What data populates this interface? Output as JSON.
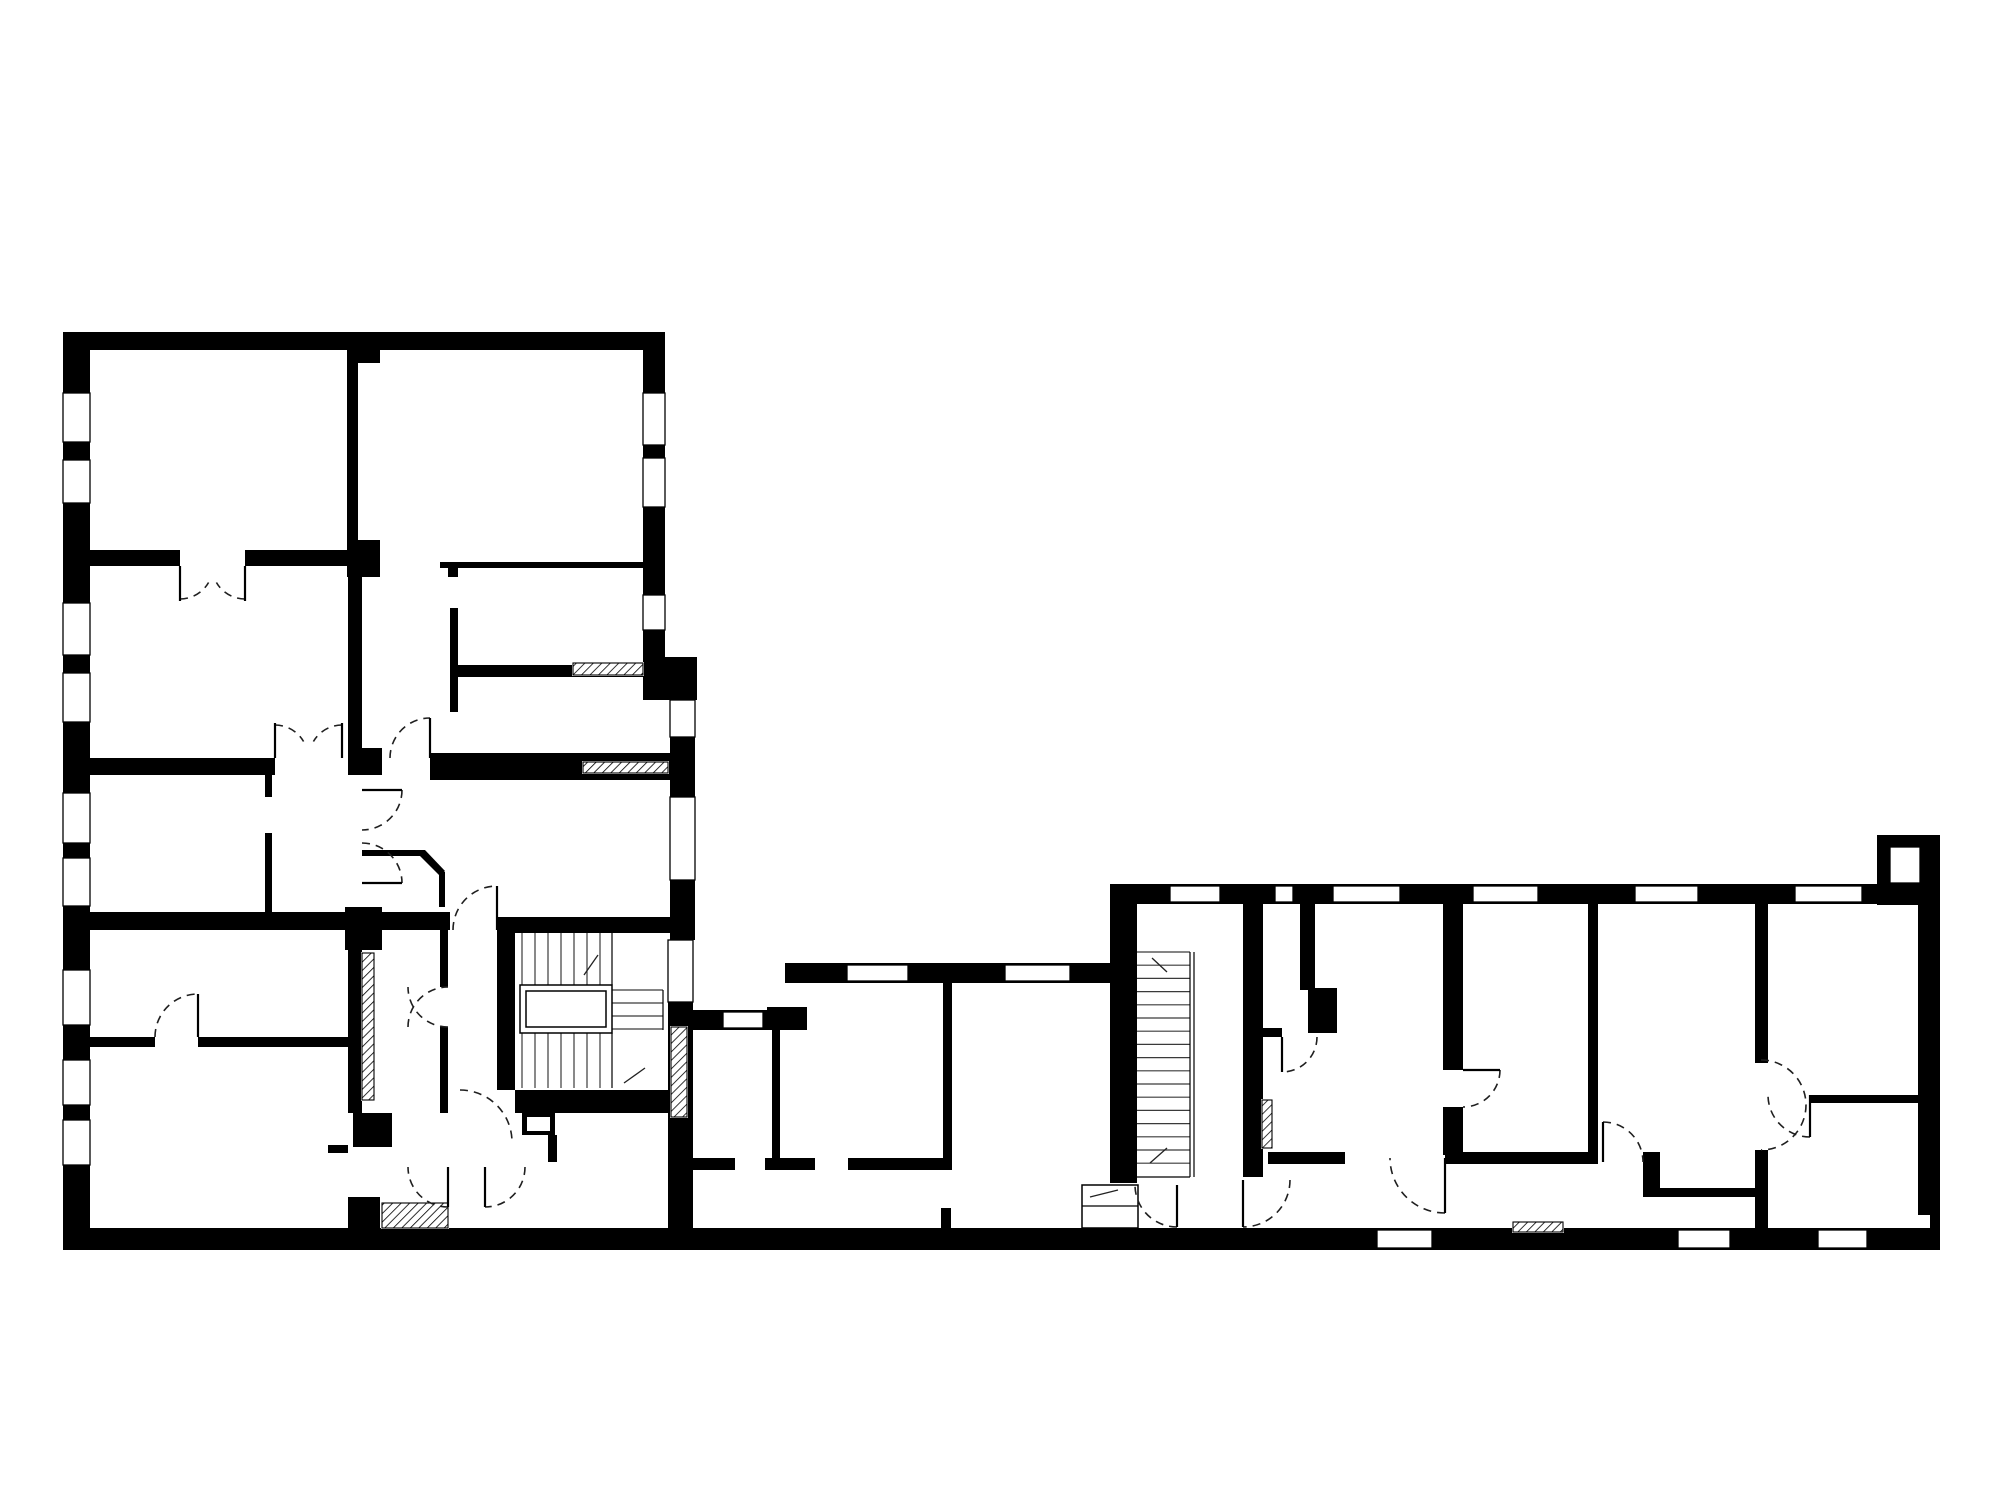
{
  "plan": {
    "canvas": {
      "width": 2000,
      "height": 1500,
      "background": "#ffffff"
    },
    "colors": {
      "wall": "#000000",
      "window_frame": "#000000",
      "tread": "#3a3a3a",
      "door_arc": "#1f1f1f",
      "hatch_line": "#000000"
    },
    "walls": [
      [
        63,
        332,
        602,
        18
      ],
      [
        63,
        332,
        27,
        918
      ],
      [
        643,
        332,
        22,
        330
      ],
      [
        643,
        657,
        54,
        43
      ],
      [
        670,
        697,
        25,
        243
      ],
      [
        668,
        940,
        25,
        290
      ],
      [
        63,
        1228,
        1877,
        22
      ],
      [
        347,
        332,
        33,
        31
      ],
      [
        347,
        350,
        11,
        192
      ],
      [
        347,
        540,
        33,
        37
      ],
      [
        90,
        550,
        90,
        16
      ],
      [
        245,
        550,
        102,
        16
      ],
      [
        440,
        562,
        207,
        6
      ],
      [
        448,
        568,
        10,
        9
      ],
      [
        450,
        608,
        8,
        104
      ],
      [
        458,
        665,
        189,
        12
      ],
      [
        430,
        753,
        245,
        27
      ],
      [
        348,
        577,
        14,
        176
      ],
      [
        348,
        748,
        34,
        27
      ],
      [
        90,
        758,
        185,
        17
      ],
      [
        265,
        775,
        7,
        22
      ],
      [
        265,
        833,
        7,
        79
      ],
      [
        90,
        912,
        258,
        18
      ],
      [
        345,
        907,
        37,
        43
      ],
      [
        382,
        912,
        68,
        18
      ],
      [
        497,
        917,
        196,
        16
      ],
      [
        362,
        850,
        63,
        6
      ],
      [
        439,
        872,
        6,
        35
      ],
      [
        348,
        950,
        14,
        163
      ],
      [
        353,
        1113,
        39,
        34
      ],
      [
        328,
        1145,
        20,
        8
      ],
      [
        90,
        1037,
        65,
        10
      ],
      [
        198,
        1037,
        150,
        10
      ],
      [
        440,
        930,
        8,
        57
      ],
      [
        440,
        1027,
        8,
        86
      ],
      [
        497,
        933,
        18,
        157
      ],
      [
        515,
        1090,
        178,
        23
      ],
      [
        522,
        1113,
        33,
        22
      ],
      [
        548,
        1135,
        9,
        27
      ],
      [
        348,
        1197,
        32,
        31
      ],
      [
        693,
        1010,
        114,
        20
      ],
      [
        785,
        963,
        330,
        20
      ],
      [
        767,
        1007,
        40,
        23
      ],
      [
        772,
        1030,
        8,
        128
      ],
      [
        943,
        983,
        9,
        187
      ],
      [
        693,
        1158,
        42,
        12
      ],
      [
        765,
        1158,
        50,
        12
      ],
      [
        848,
        1158,
        102,
        12
      ],
      [
        941,
        1208,
        10,
        20
      ],
      [
        1110,
        884,
        830,
        20
      ],
      [
        1110,
        904,
        27,
        279
      ],
      [
        1877,
        835,
        63,
        70
      ],
      [
        1918,
        904,
        22,
        324
      ],
      [
        1243,
        904,
        20,
        273
      ],
      [
        1300,
        904,
        15,
        86
      ],
      [
        1308,
        988,
        29,
        45
      ],
      [
        1260,
        1028,
        22,
        9
      ],
      [
        1443,
        904,
        20,
        166
      ],
      [
        1443,
        1107,
        20,
        48
      ],
      [
        1588,
        904,
        10,
        253
      ],
      [
        1268,
        1152,
        77,
        12
      ],
      [
        1445,
        1152,
        153,
        12
      ],
      [
        1643,
        1152,
        17,
        45
      ],
      [
        1660,
        1188,
        97,
        9
      ],
      [
        1755,
        904,
        13,
        159
      ],
      [
        1755,
        1150,
        13,
        78
      ],
      [
        1810,
        1095,
        108,
        8
      ]
    ],
    "polygons": [
      [
        [
          425,
          850
        ],
        [
          445,
          871
        ],
        [
          440,
          876
        ],
        [
          420,
          856
        ]
      ]
    ],
    "windows": [
      [
        63,
        393,
        27,
        49
      ],
      [
        63,
        460,
        27,
        43
      ],
      [
        63,
        603,
        27,
        52
      ],
      [
        63,
        673,
        27,
        49
      ],
      [
        63,
        793,
        27,
        50
      ],
      [
        63,
        858,
        27,
        48
      ],
      [
        63,
        970,
        27,
        55
      ],
      [
        63,
        1060,
        27,
        45
      ],
      [
        63,
        1120,
        27,
        45
      ],
      [
        643,
        393,
        22,
        52
      ],
      [
        643,
        458,
        22,
        49
      ],
      [
        643,
        595,
        22,
        35
      ],
      [
        670,
        700,
        25,
        37
      ],
      [
        670,
        797,
        25,
        83
      ],
      [
        668,
        940,
        25,
        62
      ],
      [
        723,
        1012,
        40,
        16
      ],
      [
        847,
        965,
        61,
        16
      ],
      [
        1005,
        965,
        65,
        16
      ],
      [
        1170,
        886,
        50,
        16
      ],
      [
        1275,
        886,
        18,
        16
      ],
      [
        1333,
        886,
        67,
        16
      ],
      [
        1473,
        886,
        65,
        16
      ],
      [
        1635,
        886,
        63,
        16
      ],
      [
        1795,
        886,
        67,
        16
      ],
      [
        1890,
        847,
        30,
        36
      ],
      [
        1377,
        1230,
        55,
        18
      ],
      [
        1678,
        1230,
        52,
        18
      ],
      [
        1818,
        1230,
        49,
        18
      ]
    ],
    "white_notches": [
      [
        527,
        1117,
        23,
        14
      ],
      [
        1918,
        1215,
        12,
        13
      ]
    ],
    "hatches": [
      [
        573,
        663,
        70,
        12
      ],
      [
        583,
        762,
        85,
        11
      ],
      [
        362,
        953,
        12,
        147
      ],
      [
        671,
        1027,
        16,
        90
      ],
      [
        382,
        1203,
        66,
        25
      ],
      [
        1262,
        1100,
        10,
        48
      ],
      [
        1513,
        1222,
        50,
        10
      ]
    ],
    "stair_outlines": [
      [
        520,
        985,
        92,
        48
      ],
      [
        526,
        991,
        80,
        36
      ],
      [
        1082,
        1185,
        56,
        43
      ]
    ],
    "stair_treads": [
      {
        "o": "v",
        "p1": 522,
        "p2": 612,
        "s": 13,
        "a": 933,
        "b": 985
      },
      {
        "o": "v",
        "p1": 522,
        "p2": 612,
        "s": 13,
        "a": 1033,
        "b": 1088
      },
      {
        "o": "h",
        "p1": 990,
        "p2": 1030,
        "s": 13,
        "a": 612,
        "b": 663
      },
      {
        "o": "h",
        "p1": 952,
        "p2": 1176,
        "s": 13.2,
        "a": 1137,
        "b": 1190
      },
      {
        "o": "v",
        "p1": 1096,
        "p2": 1124,
        "s": 14,
        "a": 1185,
        "b": 1228
      }
    ],
    "thin_lines": [
      [
        612,
        933,
        612,
        985
      ],
      [
        612,
        1033,
        612,
        1088
      ],
      [
        663,
        990,
        663,
        1030
      ],
      [
        1190,
        952,
        1190,
        1177
      ],
      [
        1194,
        952,
        1194,
        1177
      ],
      [
        1082,
        1206,
        1138,
        1206
      ],
      [
        1137,
        1177,
        1190,
        1177
      ]
    ],
    "arrows": [
      [
        598,
        955,
        584,
        975
      ],
      [
        645,
        1068,
        624,
        1083
      ],
      [
        1152,
        958,
        1167,
        972
      ],
      [
        1167,
        1148,
        1150,
        1163
      ],
      [
        1090,
        1197,
        1118,
        1190
      ]
    ],
    "doors": [
      {
        "c": [
          180,
          566
        ],
        "r": 33,
        "a0": 90,
        "a1": 30,
        "sw": 0,
        "leaf": [
          180,
          566,
          180,
          601
        ]
      },
      {
        "c": [
          245,
          566
        ],
        "r": 33,
        "a0": 90,
        "a1": 150,
        "sw": 1,
        "leaf": [
          245,
          566,
          245,
          601
        ]
      },
      {
        "c": [
          275,
          758
        ],
        "r": 33,
        "a0": 270,
        "a1": 330,
        "sw": 1,
        "leaf": [
          275,
          758,
          275,
          723
        ]
      },
      {
        "c": [
          342,
          758
        ],
        "r": 33,
        "a0": 270,
        "a1": 210,
        "sw": 0,
        "leaf": [
          342,
          758,
          342,
          723
        ]
      },
      {
        "c": [
          497,
          930
        ],
        "r": 44,
        "a0": 180,
        "a1": 270,
        "sw": 1,
        "leaf": [
          497,
          930,
          497,
          886
        ]
      },
      {
        "c": [
          198,
          1037
        ],
        "r": 43,
        "a0": 180,
        "a1": 270,
        "sw": 1,
        "leaf": [
          198,
          1037,
          198,
          994
        ]
      },
      {
        "c": [
          448,
          987
        ],
        "r": 40,
        "a0": 90,
        "a1": 180,
        "sw": 1
      },
      {
        "c": [
          448,
          1027
        ],
        "r": 40,
        "a0": 180,
        "a1": 270,
        "sw": 1
      },
      {
        "c": [
          448,
          1167
        ],
        "r": 40,
        "a0": 90,
        "a1": 180,
        "sw": 1,
        "leaf": [
          448,
          1167,
          448,
          1207
        ]
      },
      {
        "c": [
          485,
          1167
        ],
        "r": 40,
        "a0": 0,
        "a1": 90,
        "sw": 1,
        "leaf": [
          485,
          1167,
          485,
          1207
        ]
      },
      {
        "c": [
          460,
          1142
        ],
        "r": 52,
        "a0": 270,
        "a1": 360,
        "sw": 1
      },
      {
        "c": [
          362,
          790
        ],
        "r": 40,
        "a0": 0,
        "a1": 90,
        "sw": 1,
        "leaf": [
          362,
          790,
          402,
          790
        ]
      },
      {
        "c": [
          362,
          883
        ],
        "r": 40,
        "a0": 270,
        "a1": 360,
        "sw": 1,
        "leaf": [
          362,
          883,
          402,
          883
        ]
      },
      {
        "c": [
          430,
          758
        ],
        "r": 40,
        "a0": 180,
        "a1": 270,
        "sw": 1,
        "leaf": [
          430,
          758,
          430,
          718
        ]
      },
      {
        "c": [
          1177,
          1185
        ],
        "r": 42,
        "a0": 90,
        "a1": 180,
        "sw": 1,
        "leaf": [
          1177,
          1185,
          1177,
          1227
        ]
      },
      {
        "c": [
          1243,
          1180
        ],
        "r": 47,
        "a0": 0,
        "a1": 90,
        "sw": 1,
        "leaf": [
          1243,
          1180,
          1243,
          1227
        ]
      },
      {
        "c": [
          1282,
          1037
        ],
        "r": 35,
        "a0": 0,
        "a1": 90,
        "sw": 1,
        "leaf": [
          1282,
          1037,
          1282,
          1072
        ]
      },
      {
        "c": [
          1463,
          1070
        ],
        "r": 37,
        "a0": 0,
        "a1": 90,
        "sw": 1,
        "leaf": [
          1463,
          1070,
          1500,
          1070
        ]
      },
      {
        "c": [
          1445,
          1158
        ],
        "r": 55,
        "a0": 90,
        "a1": 180,
        "sw": 1,
        "leaf": [
          1445,
          1158,
          1445,
          1213
        ]
      },
      {
        "c": [
          1603,
          1162
        ],
        "r": 40,
        "a0": 270,
        "a1": 360,
        "sw": 1,
        "leaf": [
          1603,
          1162,
          1603,
          1122
        ]
      },
      {
        "c": [
          1761,
          1105
        ],
        "r": 45,
        "a0": 270,
        "a1": 90,
        "sw": 1
      },
      {
        "c": [
          1810,
          1095
        ],
        "r": 42,
        "a0": 90,
        "a1": 180,
        "sw": 1,
        "leaf": [
          1810,
          1095,
          1810,
          1137
        ]
      }
    ]
  }
}
